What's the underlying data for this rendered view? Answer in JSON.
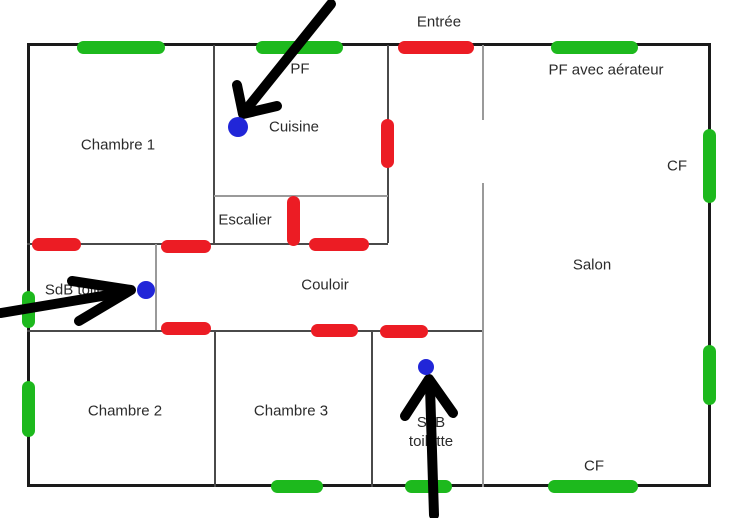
{
  "canvas": {
    "width": 742,
    "height": 518,
    "background": "#ffffff"
  },
  "colors": {
    "outer_wall": "#1a1a1a",
    "inner_wall_dark": "#4a4a4a",
    "inner_wall_light": "#9a9a9a",
    "green_marker": "#1db91d",
    "red_marker": "#ec1c24",
    "blue_point": "#2126d8",
    "arrow": "#000000",
    "label_text": "#2b2b2b"
  },
  "plan": {
    "outer_wall": {
      "x": 27,
      "y": 43,
      "width": 684,
      "height": 444
    },
    "inner_walls": [
      {
        "name": "wall-chambre1-cuisine",
        "x1": 214,
        "y1": 45,
        "x2": 214,
        "y2": 244,
        "shade": "dark"
      },
      {
        "name": "wall-cuisine-entree",
        "x1": 388,
        "y1": 45,
        "x2": 388,
        "y2": 243,
        "shade": "dark"
      },
      {
        "name": "wall-escalier-top",
        "x1": 214,
        "y1": 196,
        "x2": 388,
        "y2": 196,
        "shade": "light"
      },
      {
        "name": "wall-couloir-top",
        "x1": 27,
        "y1": 244,
        "x2": 388,
        "y2": 244,
        "shade": "dark"
      },
      {
        "name": "wall-sdb-toilettes-right",
        "x1": 156,
        "y1": 244,
        "x2": 156,
        "y2": 331,
        "shade": "light"
      },
      {
        "name": "wall-couloir-bottom",
        "x1": 27,
        "y1": 331,
        "x2": 483,
        "y2": 331,
        "shade": "dark"
      },
      {
        "name": "wall-chambre2-chambre3",
        "x1": 215,
        "y1": 331,
        "x2": 215,
        "y2": 487,
        "shade": "dark"
      },
      {
        "name": "wall-chambre3-sdb",
        "x1": 372,
        "y1": 331,
        "x2": 372,
        "y2": 487,
        "shade": "dark"
      },
      {
        "name": "wall-entree-salon",
        "x1": 483,
        "y1": 45,
        "x2": 483,
        "y2": 120,
        "shade": "light"
      },
      {
        "name": "wall-salon-left",
        "x1": 483,
        "y1": 183,
        "x2": 483,
        "y2": 487,
        "shade": "light"
      }
    ],
    "green_markers": [
      {
        "name": "green-marker-top-chambre1",
        "x": 77,
        "y": 41,
        "w": 88,
        "h": 13
      },
      {
        "name": "green-marker-top-cuisine",
        "x": 256,
        "y": 41,
        "w": 87,
        "h": 13
      },
      {
        "name": "green-marker-top-salon",
        "x": 551,
        "y": 41,
        "w": 87,
        "h": 13
      },
      {
        "name": "green-marker-left-sdb",
        "x": 22,
        "y": 291,
        "w": 13,
        "h": 37
      },
      {
        "name": "green-marker-left-chambre2",
        "x": 22,
        "y": 381,
        "w": 13,
        "h": 56
      },
      {
        "name": "green-marker-right-salon-cf",
        "x": 703,
        "y": 129,
        "w": 13,
        "h": 74
      },
      {
        "name": "green-marker-right-salon-2",
        "x": 703,
        "y": 345,
        "w": 13,
        "h": 60
      },
      {
        "name": "green-marker-bottom-chambre3",
        "x": 271,
        "y": 480,
        "w": 52,
        "h": 13
      },
      {
        "name": "green-marker-bottom-sdb",
        "x": 405,
        "y": 480,
        "w": 47,
        "h": 13
      },
      {
        "name": "green-marker-bottom-salon-cf",
        "x": 548,
        "y": 480,
        "w": 90,
        "h": 13
      }
    ],
    "red_markers": [
      {
        "name": "red-marker-entree-door",
        "x": 398,
        "y": 41,
        "w": 76,
        "h": 13
      },
      {
        "name": "red-marker-cuisine-entree",
        "x": 381,
        "y": 119,
        "w": 13,
        "h": 49
      },
      {
        "name": "red-marker-escalier",
        "x": 287,
        "y": 196,
        "w": 13,
        "h": 50
      },
      {
        "name": "red-marker-sdb1-top",
        "x": 32,
        "y": 238,
        "w": 49,
        "h": 13
      },
      {
        "name": "red-marker-couloir-top-left",
        "x": 161,
        "y": 240,
        "w": 50,
        "h": 13
      },
      {
        "name": "red-marker-couloir-top-right",
        "x": 309,
        "y": 238,
        "w": 60,
        "h": 13
      },
      {
        "name": "red-marker-couloir-bottom-1",
        "x": 161,
        "y": 322,
        "w": 50,
        "h": 13
      },
      {
        "name": "red-marker-couloir-bottom-2",
        "x": 311,
        "y": 324,
        "w": 47,
        "h": 13
      },
      {
        "name": "red-marker-sdb2-top",
        "x": 380,
        "y": 325,
        "w": 48,
        "h": 13
      }
    ],
    "blue_points": [
      {
        "name": "blue-point-cuisine",
        "cx": 238,
        "cy": 127,
        "r": 10
      },
      {
        "name": "blue-point-sdb-toilettes",
        "cx": 146,
        "cy": 290,
        "r": 9
      },
      {
        "name": "blue-point-sdb-toilette",
        "cx": 426,
        "cy": 367,
        "r": 8
      }
    ],
    "arrows": [
      {
        "name": "arrow-to-cuisine-point",
        "shaft": [
          331,
          4,
          245,
          111
        ],
        "wings": [
          237,
          85,
          243,
          114,
          277,
          106
        ]
      },
      {
        "name": "arrow-to-sdb1-point",
        "shaft": [
          1,
          313,
          126,
          292
        ],
        "wings": [
          72,
          281,
          131,
          290,
          79,
          321
        ]
      },
      {
        "name": "arrow-to-sdb2-point",
        "shaft": [
          434,
          515,
          430,
          387
        ],
        "wings": [
          405,
          416,
          429,
          379,
          453,
          413
        ]
      }
    ],
    "labels": [
      {
        "id": "label-entree",
        "text": "Entrée",
        "x": 439,
        "y": 22
      },
      {
        "id": "label-pf",
        "text": "PF",
        "x": 300,
        "y": 69
      },
      {
        "id": "label-pf-aerateur",
        "text": "PF avec aérateur",
        "x": 606,
        "y": 70
      },
      {
        "id": "label-cuisine",
        "text": "Cuisine",
        "x": 294,
        "y": 127
      },
      {
        "id": "label-chambre1",
        "text": "Chambre 1",
        "x": 118,
        "y": 145
      },
      {
        "id": "label-cf-right",
        "text": "CF",
        "x": 677,
        "y": 166
      },
      {
        "id": "label-escalier",
        "text": "Escalier",
        "x": 245,
        "y": 220
      },
      {
        "id": "label-salon",
        "text": "Salon",
        "x": 592,
        "y": 265
      },
      {
        "id": "label-couloir",
        "text": "Couloir",
        "x": 325,
        "y": 285
      },
      {
        "id": "label-sdb-toilettes",
        "text": "SdB toilettes",
        "x": 87,
        "y": 290
      },
      {
        "id": "label-chambre2",
        "text": "Chambre 2",
        "x": 125,
        "y": 411
      },
      {
        "id": "label-chambre3",
        "text": "Chambre 3",
        "x": 291,
        "y": 411
      },
      {
        "id": "label-sdb-toilette",
        "text": "SdB\ntoilette",
        "x": 431,
        "y": 432
      },
      {
        "id": "label-cf-bottom",
        "text": "CF",
        "x": 594,
        "y": 466
      }
    ]
  }
}
